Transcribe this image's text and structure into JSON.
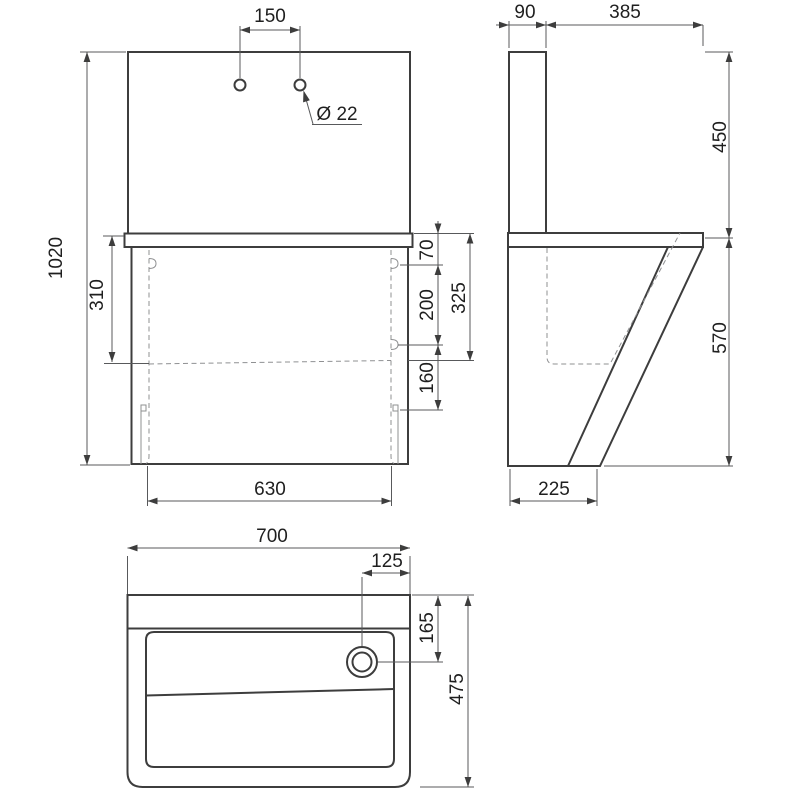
{
  "drawing_title": "wall-mounted-sink-technical-drawing-three-views",
  "front_view": {
    "tap_hole_spacing": "150",
    "tap_hole_diameter": "Ø 22",
    "overall_height": "1020",
    "basin_inner_depth": "310",
    "rim_to_upper_fixing": "70",
    "fixing_vertical_spacing": "200",
    "rim_to_drain_level": "325",
    "drain_level_to_lower_fixing": "160",
    "fixing_horizontal_spacing": "630"
  },
  "side_view": {
    "splashback_thickness": "90",
    "top_depth": "385",
    "splashback_height": "450",
    "body_height": "570",
    "bottom_depth": "225"
  },
  "plan_view": {
    "overall_width": "700",
    "drain_offset_from_right": "125",
    "drain_offset_from_back": "165",
    "overall_depth": "475"
  },
  "colors": {
    "outline": "#3d3d3d",
    "dimension_lines": "#58595b",
    "hidden_lines": "#8f9092",
    "text": "#1f1f1f",
    "background": "#ffffff"
  }
}
